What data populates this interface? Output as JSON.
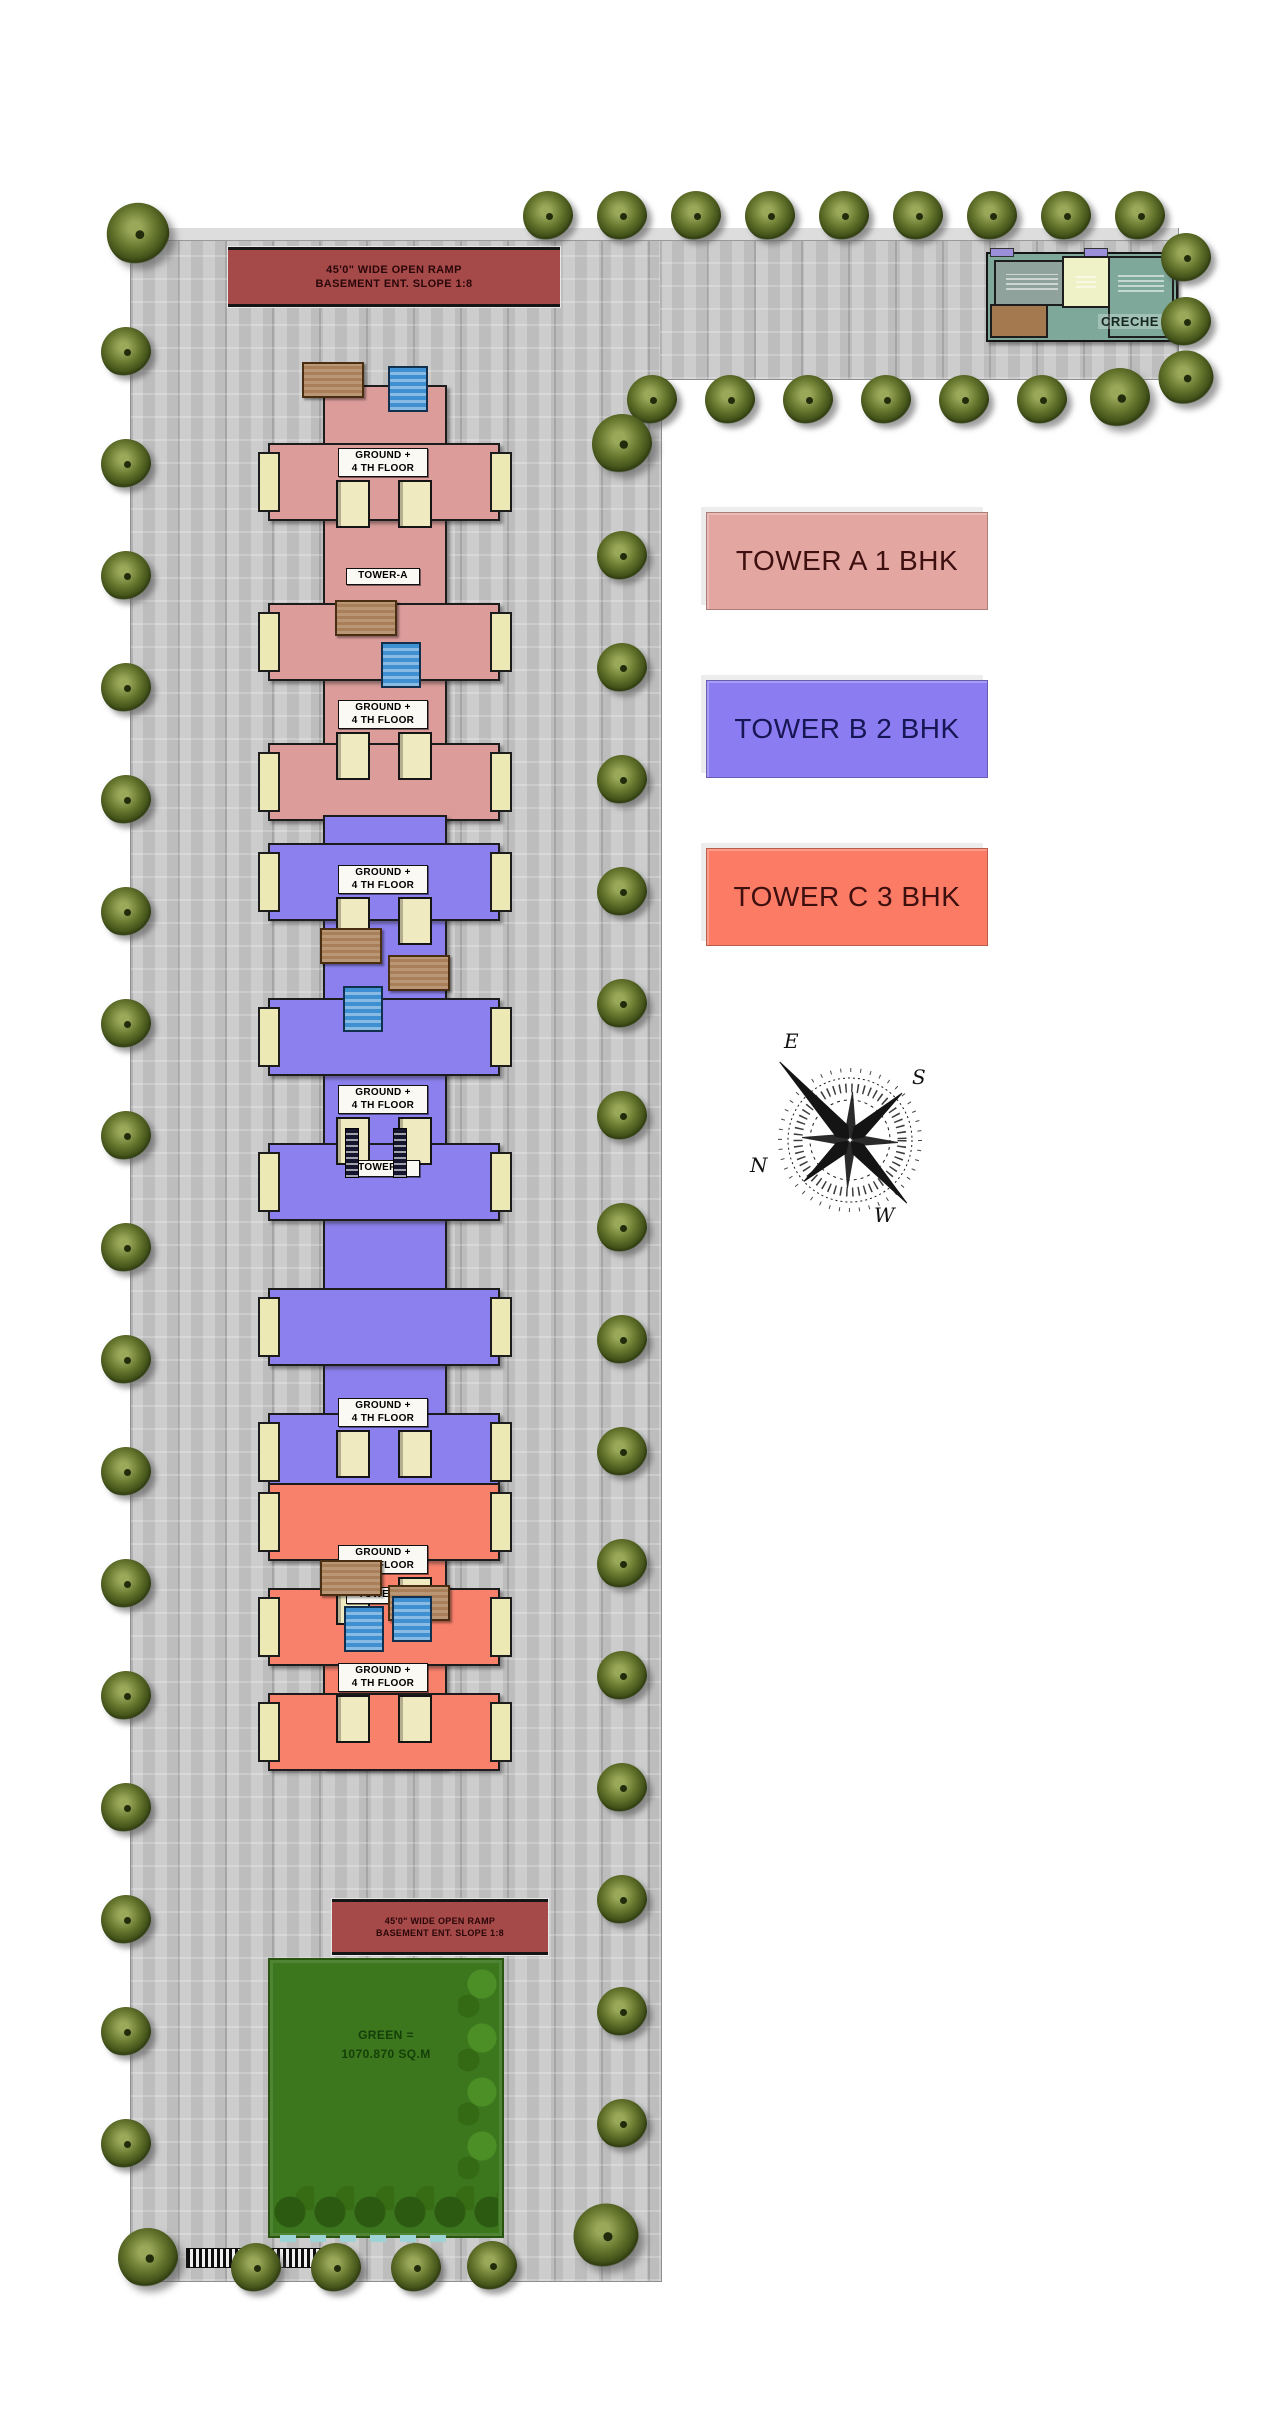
{
  "banners": {
    "top": {
      "line1": "45'0\" WIDE OPEN RAMP",
      "line2": "BASEMENT ENT. SLOPE 1:8"
    },
    "bottom": {
      "line1": "45'0\" WIDE OPEN RAMP",
      "line2": "BASEMENT ENT. SLOPE 1:8"
    }
  },
  "legend": {
    "items": [
      {
        "label": "TOWER A 1 BHK",
        "color": "#e3a6a1",
        "text_color": "#3d0f0f"
      },
      {
        "label": "TOWER B 2 BHK",
        "color": "#8b7cf2",
        "text_color": "#161654"
      },
      {
        "label": "TOWER C 3 BHK",
        "color": "#fb7b65",
        "text_color": "#3d0f0f"
      }
    ]
  },
  "creche": {
    "label": "CRECHE"
  },
  "green_area": {
    "line1": "GREEN =",
    "line2": "1070.870 SQ.M"
  },
  "compass": {
    "north": "N",
    "east": "E",
    "south": "S",
    "west": "W"
  },
  "towers": [
    {
      "name": "TOWER-A",
      "floors": "GROUND +\n4 TH FLOOR",
      "color": "#db9c9a",
      "x": 272,
      "y": 385,
      "w": 222,
      "h": 430,
      "wings": [
        95,
        255,
        395
      ],
      "floor_labels": [
        63,
        315
      ],
      "name_label": 183
    },
    {
      "name": "TOWER-B",
      "floors": "GROUND +\n4 TH FLOOR",
      "color": "#8b80ee",
      "x": 272,
      "y": 815,
      "w": 222,
      "h": 680,
      "wings": [
        65,
        220,
        365,
        510,
        635
      ],
      "floor_labels": [
        50,
        270,
        583
      ],
      "name_label": 345
    },
    {
      "name": "TOWER-C",
      "floors": "GROUND +\n4 TH FLOOR",
      "color": "#f8816c",
      "x": 272,
      "y": 1495,
      "w": 222,
      "h": 270,
      "wings": [
        25,
        130,
        235
      ],
      "floor_labels": [
        50,
        168
      ],
      "name_label": 92
    }
  ],
  "decorations": {
    "mats": [
      [
        302,
        362
      ],
      [
        335,
        600
      ],
      [
        320,
        928
      ],
      [
        388,
        955
      ],
      [
        320,
        1560
      ],
      [
        388,
        1585
      ]
    ],
    "tanks": [
      [
        388,
        366
      ],
      [
        381,
        642
      ],
      [
        343,
        986
      ],
      [
        344,
        1606
      ],
      [
        392,
        1596
      ]
    ],
    "windows": [
      [
        345,
        1128
      ],
      [
        393,
        1128
      ]
    ]
  },
  "trees": {
    "positions": [
      [
        138,
        234,
        1.25
      ],
      [
        126,
        352
      ],
      [
        126,
        464
      ],
      [
        126,
        576
      ],
      [
        126,
        688
      ],
      [
        126,
        800
      ],
      [
        126,
        912
      ],
      [
        126,
        1024
      ],
      [
        126,
        1136
      ],
      [
        126,
        1248
      ],
      [
        126,
        1360
      ],
      [
        126,
        1472
      ],
      [
        126,
        1584
      ],
      [
        126,
        1696
      ],
      [
        126,
        1808
      ],
      [
        126,
        1920
      ],
      [
        126,
        2032
      ],
      [
        126,
        2144
      ],
      [
        148,
        2258,
        1.2
      ],
      [
        548,
        216
      ],
      [
        622,
        216
      ],
      [
        696,
        216
      ],
      [
        770,
        216
      ],
      [
        844,
        216
      ],
      [
        918,
        216
      ],
      [
        992,
        216
      ],
      [
        1066,
        216
      ],
      [
        1140,
        216
      ],
      [
        1186,
        258
      ],
      [
        1186,
        322
      ],
      [
        1186,
        378,
        1.1
      ],
      [
        652,
        400
      ],
      [
        730,
        400
      ],
      [
        808,
        400
      ],
      [
        886,
        400
      ],
      [
        964,
        400
      ],
      [
        1042,
        400
      ],
      [
        1120,
        398,
        1.2
      ],
      [
        622,
        444,
        1.2
      ],
      [
        622,
        556
      ],
      [
        622,
        668
      ],
      [
        622,
        780
      ],
      [
        622,
        892
      ],
      [
        622,
        1004
      ],
      [
        622,
        1116
      ],
      [
        622,
        1228
      ],
      [
        622,
        1340
      ],
      [
        622,
        1452
      ],
      [
        622,
        1564
      ],
      [
        622,
        1676
      ],
      [
        622,
        1788
      ],
      [
        622,
        1900
      ],
      [
        622,
        2012
      ],
      [
        622,
        2124
      ],
      [
        606,
        2236,
        1.3
      ],
      [
        256,
        2268
      ],
      [
        336,
        2268
      ],
      [
        416,
        2268
      ],
      [
        492,
        2266
      ]
    ]
  }
}
